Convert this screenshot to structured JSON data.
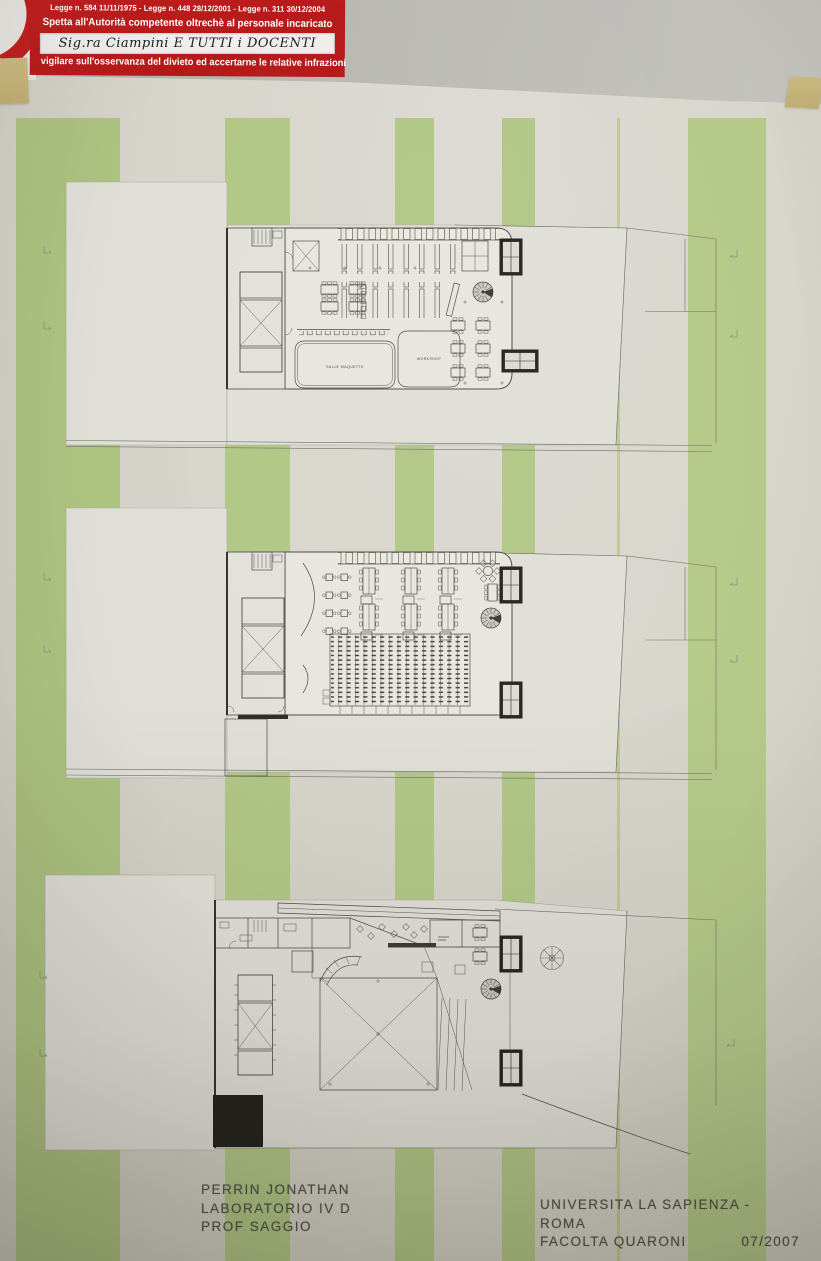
{
  "sign": {
    "line_fragment": "in presenza di una donna",
    "line_small": "in evidente stato di gravidanza o in presenza di lattanti o bambini fino a dodici anni",
    "laws": "Legge n. 584 11/11/1975 - Legge n. 448 28/12/2001 - Legge n. 311 30/12/2004",
    "authority": "Spetta all'Autorità competente oltrechè al personale incaricato",
    "handwritten": "Sig.ra Ciampini  E TUTTI i DOCENTI",
    "footer": "vigilare sull'osservanza del divieto ed accertarne le relative infrazioni"
  },
  "plans": {
    "ground_floor_labels": {
      "salle_maquette": "SALLE MAQUETTE",
      "workshop": "WORKSHOP"
    }
  },
  "credits": {
    "author": "PERRIN JONATHAN",
    "course": "LABORATORIO IV D",
    "professor": "PROF SAGGIO",
    "university": "UNIVERSITA LA SAPIENZA  -  ROMA",
    "faculty": "FACOLTA QUARONI",
    "date": "07/2007"
  },
  "colors": {
    "poster_background": "#d6d4ca",
    "stripe_green": "#aec67f",
    "sign_red": "#bf1d1d",
    "tape_tan": "#c9b77d",
    "plan_line": "#4b4a44",
    "wall_gray": "#b9b8b3",
    "black_fill": "#201f1b"
  }
}
